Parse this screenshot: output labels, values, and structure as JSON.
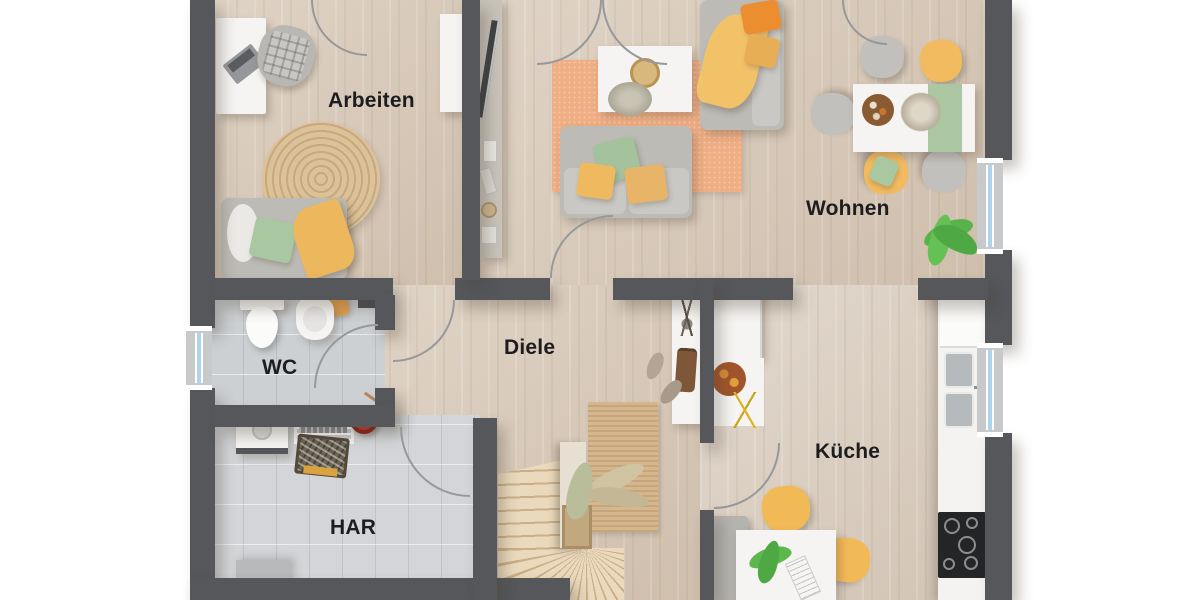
{
  "figure": {
    "kind": "architectural floor plan, photorealistic top-down 3D render",
    "background": "white"
  },
  "rooms": {
    "arbeiten": {
      "label": "Arbeiten"
    },
    "wohnen": {
      "label": "Wohnen"
    },
    "diele": {
      "label": "Diele"
    },
    "wc": {
      "label": "WC"
    },
    "kueche": {
      "label": "Küche"
    },
    "har": {
      "label": "HAR"
    }
  },
  "colors": {
    "wall": "#55575b",
    "wood_floor": "#d8c9b8",
    "tile_floor": "#d3d5d8",
    "rug_orange": "#efae84",
    "rug_jute": "#d6b68c",
    "accent_yellow": "#f0b95e",
    "accent_green": "#a9c7a1",
    "accent_orange": "#ec8d2f",
    "accent_red": "#c0392b",
    "window_glass": "#aed3ec",
    "stair_wood": "#ead9bc",
    "label_text": "#1d1d1f"
  }
}
